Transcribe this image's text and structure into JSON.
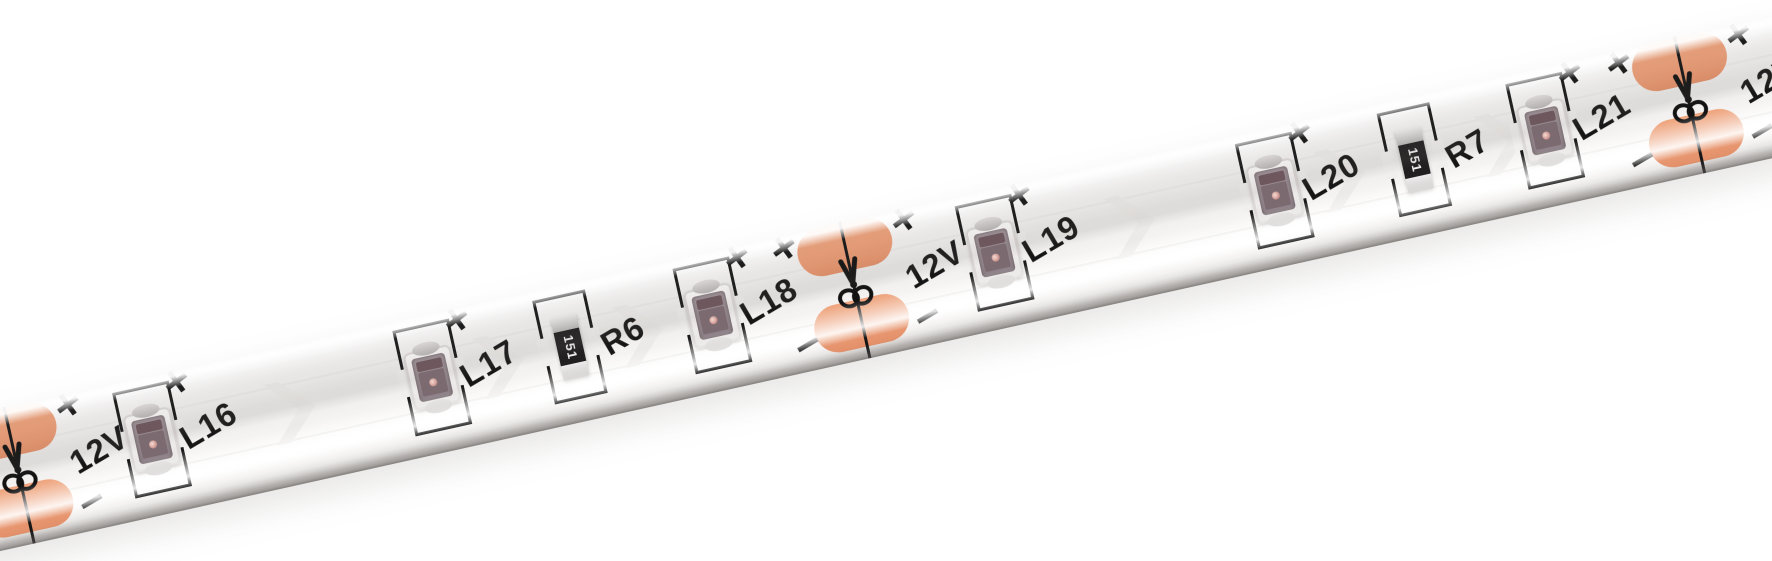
{
  "photo": {
    "subject": "12V flexible LED strip photographed diagonally on white background"
  },
  "strip": {
    "voltage_label": "12V",
    "plus_mark": "+",
    "minus_mark": "−",
    "leds": [
      {
        "label": "L16"
      },
      {
        "label": "L17"
      },
      {
        "label": "L18"
      },
      {
        "label": "L19"
      },
      {
        "label": "L20"
      },
      {
        "label": "L21"
      }
    ],
    "resistors": [
      {
        "label": "R6",
        "code": "151"
      },
      {
        "label": "R7",
        "code": "151"
      }
    ],
    "colors": {
      "solder_pad": "#EC9E78",
      "silkscreen_print": "#1A1A1A",
      "strip_surface": "#F2F0EF",
      "led_window": "#93878D",
      "resistor_body": "#211F20",
      "background": "#FFFFFF"
    }
  }
}
